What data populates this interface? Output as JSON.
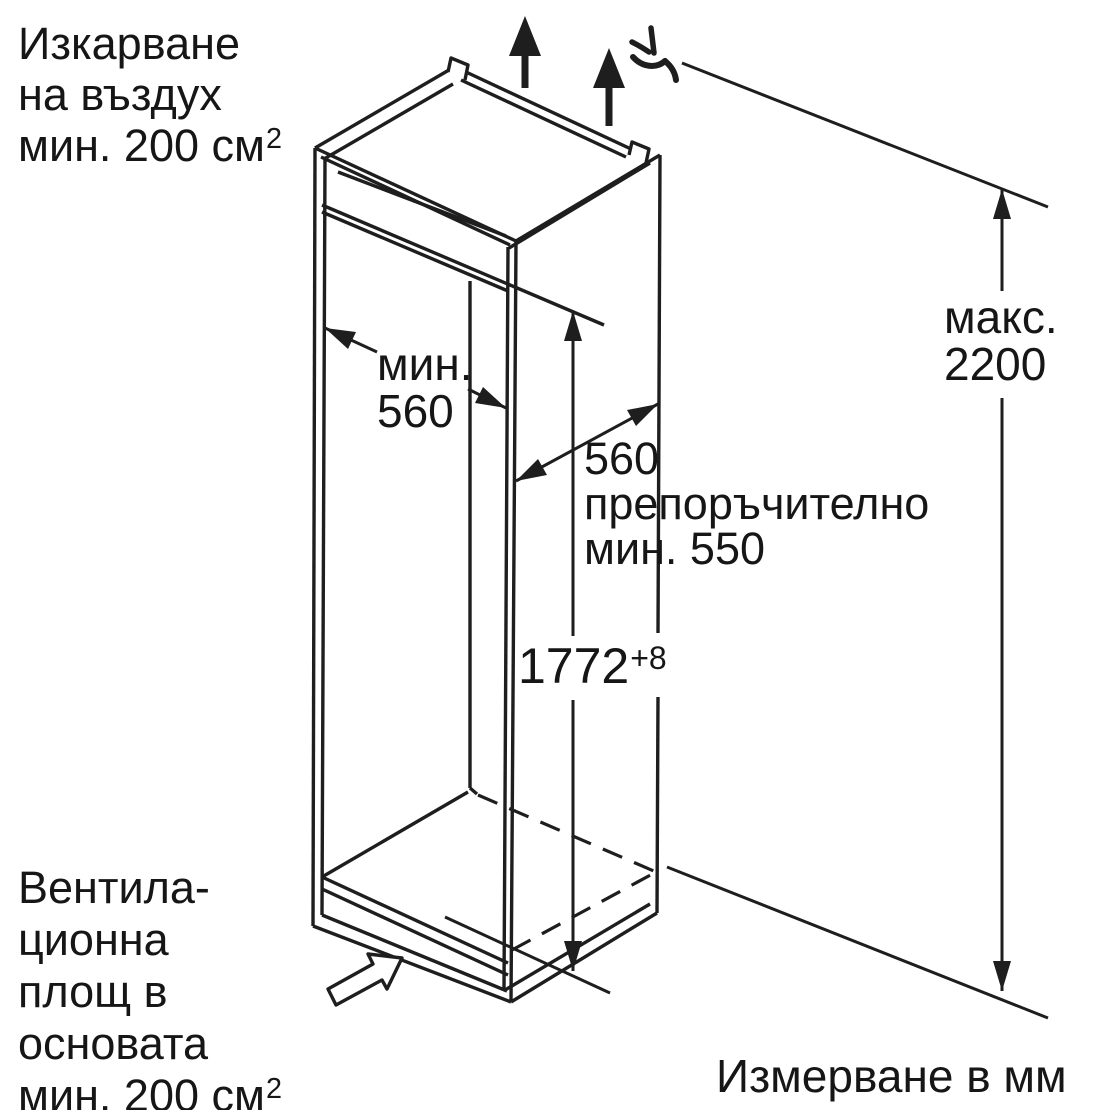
{
  "figure": {
    "kind": "built-in appliance niche installation drawing",
    "units_note": "Измерване в мм"
  },
  "labels": {
    "air_outlet_top": {
      "line1": "Изкарване",
      "line2": "на въздух",
      "line3": "мин. 200 см",
      "line3_sup": "2"
    },
    "ventilation_base": {
      "line1": "Вентила-",
      "line2": "ционна",
      "line3": "площ в",
      "line4": "основата",
      "line5": "мин. 200 см",
      "line5_sup": "2"
    }
  },
  "dimensions": {
    "niche_width_min": {
      "line1": "мин.",
      "line2": "560"
    },
    "niche_depth": {
      "line1": "560",
      "line2": "препоръчително",
      "line3": "мин. 550"
    },
    "niche_height": {
      "value": "1772",
      "tolerance": "+8"
    },
    "max_overall_height": {
      "line1": "макс.",
      "line2": "2200"
    }
  },
  "icons": {
    "air_flow": "arrow-up-filled",
    "air_gap_mark": "curved-squiggle",
    "base_airflow": "hollow-arrow-up-right",
    "dimension_ends": "slender-triangle-arrowheads"
  },
  "colors": {
    "line": "#1e1e1e",
    "text": "#161616",
    "background": "#ffffff"
  }
}
